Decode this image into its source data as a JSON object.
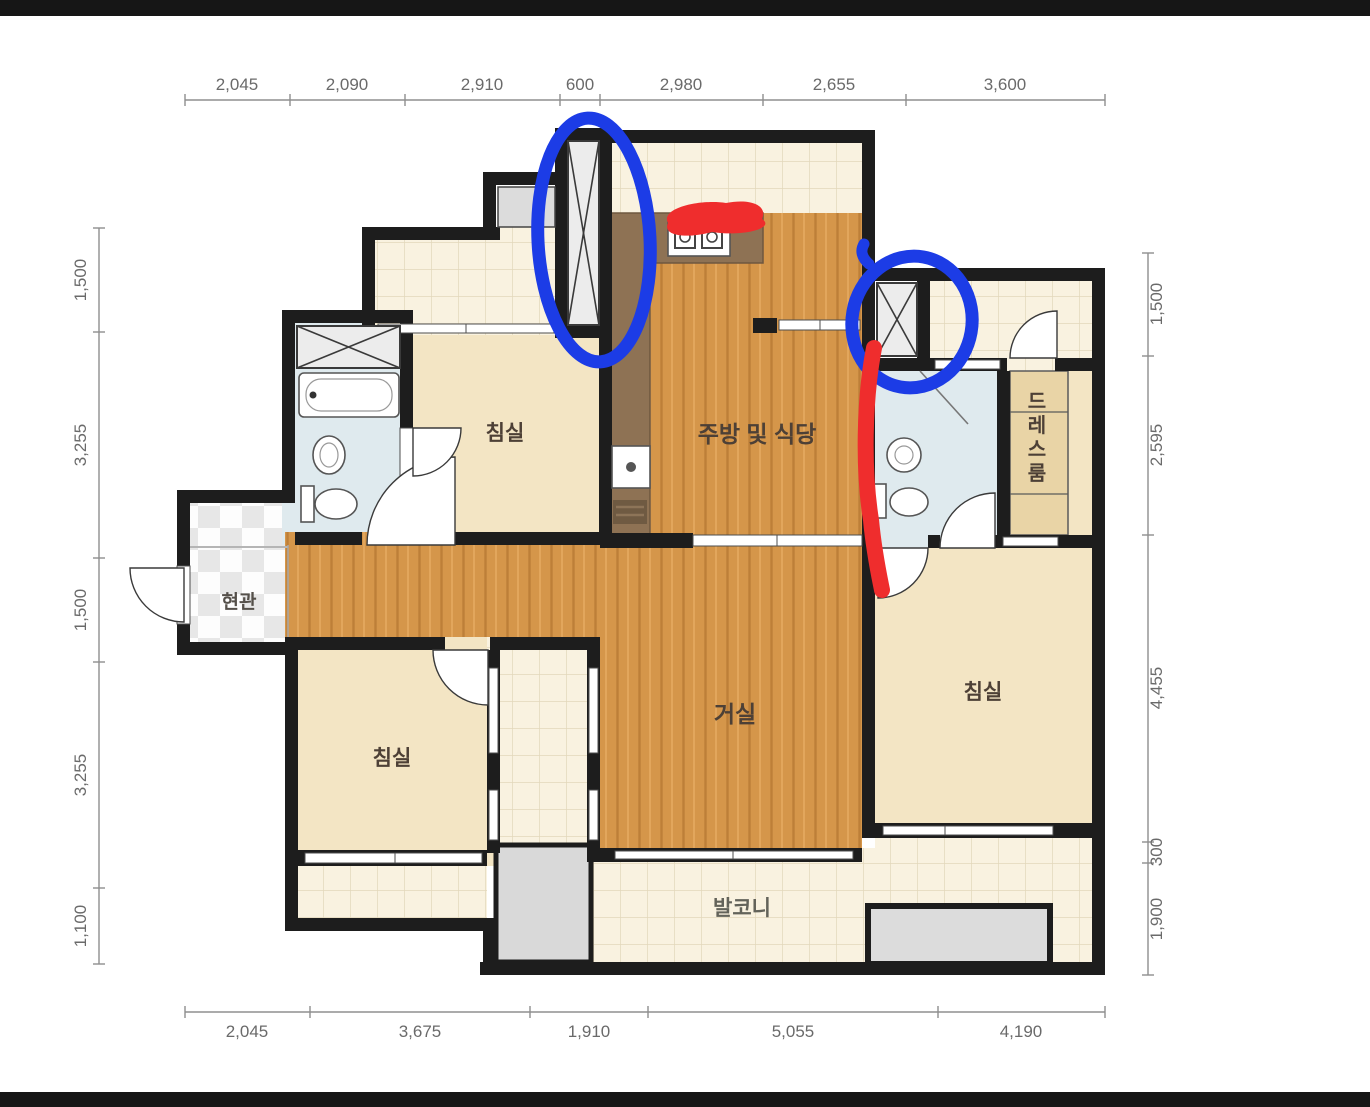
{
  "dims": {
    "top": [
      "2,045",
      "2,090",
      "2,910",
      "600",
      "2,980",
      "2,655",
      "3,600"
    ],
    "bottom": [
      "2,045",
      "3,675",
      "1,910",
      "5,055",
      "4,190"
    ],
    "left": [
      "1,500",
      "3,255",
      "1,500",
      "3,255",
      "1,100"
    ],
    "right": [
      "1,500",
      "2,595",
      "4,455",
      "300",
      "1,900"
    ]
  },
  "rooms": {
    "bedroom_top_left": "침실",
    "bedroom_bottom_left": "침실",
    "bedroom_right": "침실",
    "living_room": "거실",
    "kitchen_dining": "주방 및 식당",
    "balcony": "발코니",
    "entrance": "현관",
    "dress_room": "드레스룸"
  },
  "colors": {
    "wall": "#1d1d1d",
    "wood_floor": "#d5964a",
    "tile_floor": "#f9f2e0",
    "bedroom_floor": "#f3e5c4",
    "bathroom_floor": "#dfeaee",
    "kitchen_counter": "#8e7254",
    "gray_unit": "#d9d9d9",
    "annotation_blue": "#1c3ce6",
    "annotation_red": "#ef2d2d"
  }
}
